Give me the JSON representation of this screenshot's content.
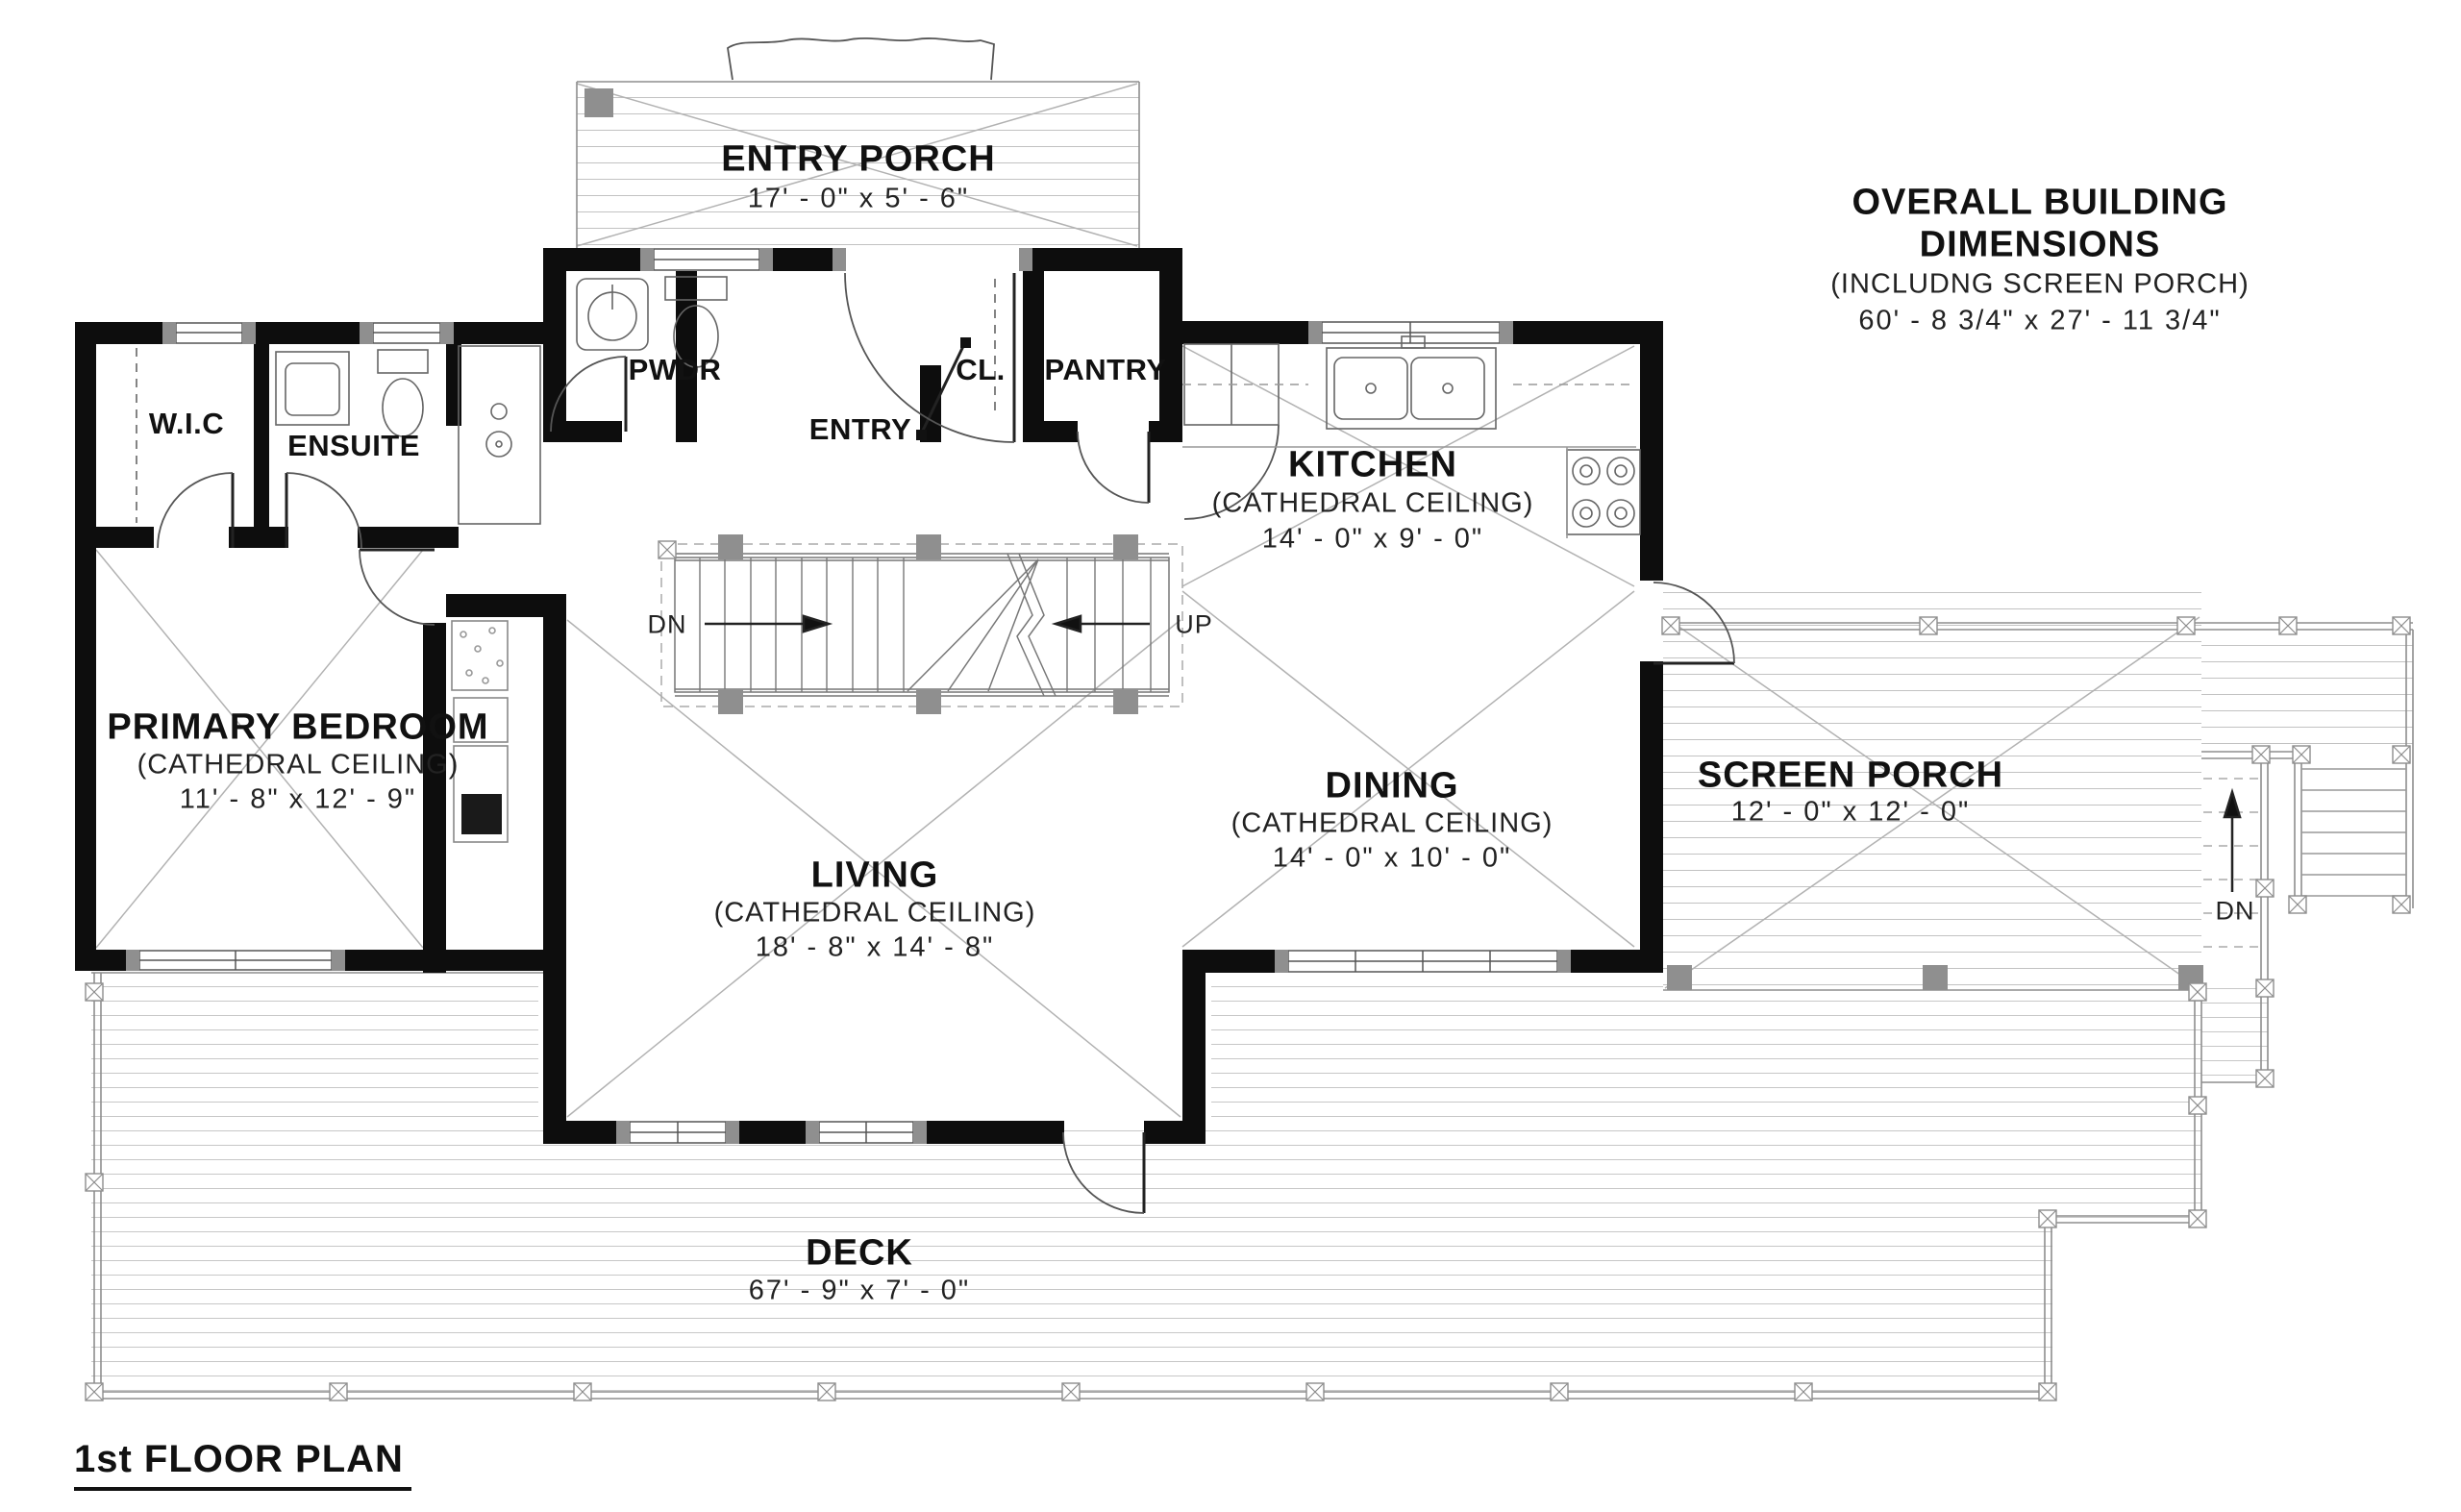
{
  "sheet": {
    "title": "1st FLOOR PLAN"
  },
  "overall_dimensions": {
    "title": "OVERALL BUILDING DIMENSIONS",
    "subtitle": "(INCLUDNG SCREEN PORCH)",
    "value": "60' - 8 3/4\" x 27' - 11 3/4\""
  },
  "rooms": {
    "entry_porch": {
      "name": "ENTRY PORCH",
      "dims": "17' - 0\" x 5' - 6\""
    },
    "pwdr": {
      "name": "PWDR"
    },
    "entry": {
      "name": "ENTRY"
    },
    "cl": {
      "name": "CL."
    },
    "pantry": {
      "name": "PANTRY"
    },
    "wic": {
      "name": "W.I.C"
    },
    "ensuite": {
      "name": "ENSUITE"
    },
    "kitchen": {
      "name": "KITCHEN",
      "ceiling": "(CATHEDRAL CEILING)",
      "dims": "14' - 0\" x 9' - 0\""
    },
    "primary_bedroom": {
      "name": "PRIMARY BEDROOM",
      "ceiling": "(CATHEDRAL CEILING)",
      "dims": "11' - 8\" x 12' - 9\""
    },
    "living": {
      "name": "LIVING",
      "ceiling": "(CATHEDRAL CEILING)",
      "dims": "18' - 8\" x 14' - 8\""
    },
    "dining": {
      "name": "DINING",
      "ceiling": "(CATHEDRAL CEILING)",
      "dims": "14' - 0\" x 10' - 0\""
    },
    "screen_porch": {
      "name": "SCREEN PORCH",
      "dims": "12' - 0\" x 12' - 0\""
    },
    "deck": {
      "name": "DECK",
      "dims": "67' - 9\" x 7' - 0\""
    }
  },
  "stair_annotations": {
    "down": "DN",
    "up": "UP",
    "deck_down": "DN"
  },
  "colors": {
    "wall": "#0d0d0d",
    "post_gray": "#8f8f8f",
    "line_gray": "#9b9b9b",
    "plank_gray": "#c7c7c7",
    "text": "#111111",
    "background": "#ffffff"
  }
}
